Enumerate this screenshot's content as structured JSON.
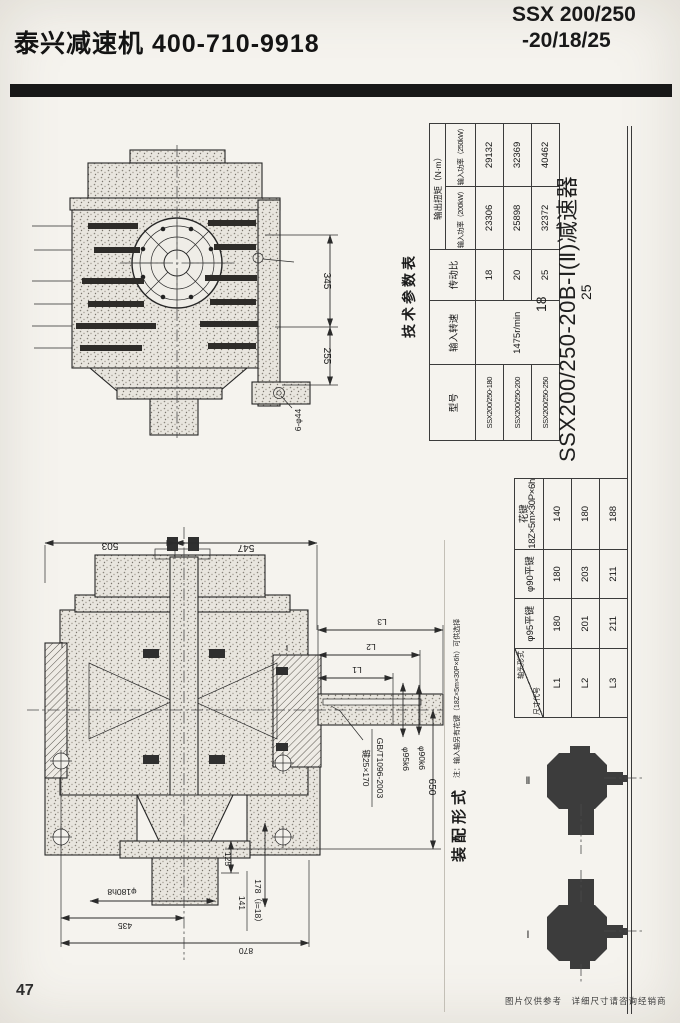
{
  "header": {
    "company": "泰兴减速机  400-710-9918",
    "model_line1": "SSX 200/250",
    "model_line2": "-20/18/25"
  },
  "page_number": "47",
  "disclaimer": "图片仅供参考　详细尺寸请咨询经销商",
  "params_table": {
    "title": "技术参数表",
    "col_model": "型号",
    "col_speed": "输入转速",
    "col_ratio": "传动比",
    "col_torque": "输出扭矩（N·m）",
    "col_p200": "输入功率（200kW）",
    "col_p250": "输入功率（250kW）",
    "speed": "1475r/min",
    "rows": [
      {
        "model": "SSX200/250-180",
        "ratio": "18",
        "t200": "23306",
        "t250": "29132"
      },
      {
        "model": "SSX200/250-200",
        "ratio": "20",
        "t200": "25898",
        "t250": "32369"
      },
      {
        "model": "SSX200/250-250",
        "ratio": "25",
        "t200": "32372",
        "t250": "40462"
      }
    ]
  },
  "model_title": {
    "alt_top": "18",
    "main": "SSX200/250-20B-Ⅰ(Ⅱ)减速器",
    "alt_bottom": "25"
  },
  "dims_table": {
    "diag_top": "轴头形式",
    "diag_bottom": "尺寸代号",
    "col1": "φ95平键",
    "col2": "φ90平键",
    "col3a": "花键",
    "col3b": "18Z×5m×30P×6h",
    "rows": [
      {
        "code": "L1",
        "v1": "180",
        "v2": "180",
        "v3": "140"
      },
      {
        "code": "L2",
        "v1": "201",
        "v2": "203",
        "v3": "180"
      },
      {
        "code": "L3",
        "v1": "211",
        "v2": "211",
        "v3": "188"
      }
    ]
  },
  "note": "注：输入轴另有花键（18Z×5m×30P×6h）可供选择",
  "assembly": {
    "title": "装配形式",
    "label_top": "Ⅱ",
    "label_bottom": "Ⅰ"
  },
  "top_view": {
    "dim_a": "345",
    "dim_b": "255",
    "dim_holes": "6-φ44"
  },
  "section_view": {
    "dim_503": "503",
    "dim_547": "547",
    "l1": "L1",
    "l2": "L2",
    "l3": "L3",
    "dim_650": "650",
    "dim_125": "125",
    "dim_141": "141",
    "dim_178": "178（i=18）",
    "dim_flange": "φ180h8",
    "dim_435": "435",
    "dim_870": "870",
    "shaft_d95": "φ95k6",
    "shaft_d90": "φ90k6",
    "key_spec": "键25×170",
    "key_std": "GB/T1096-2003",
    "mark_left": "Ⅰ",
    "mark_right": "Ⅰ"
  }
}
